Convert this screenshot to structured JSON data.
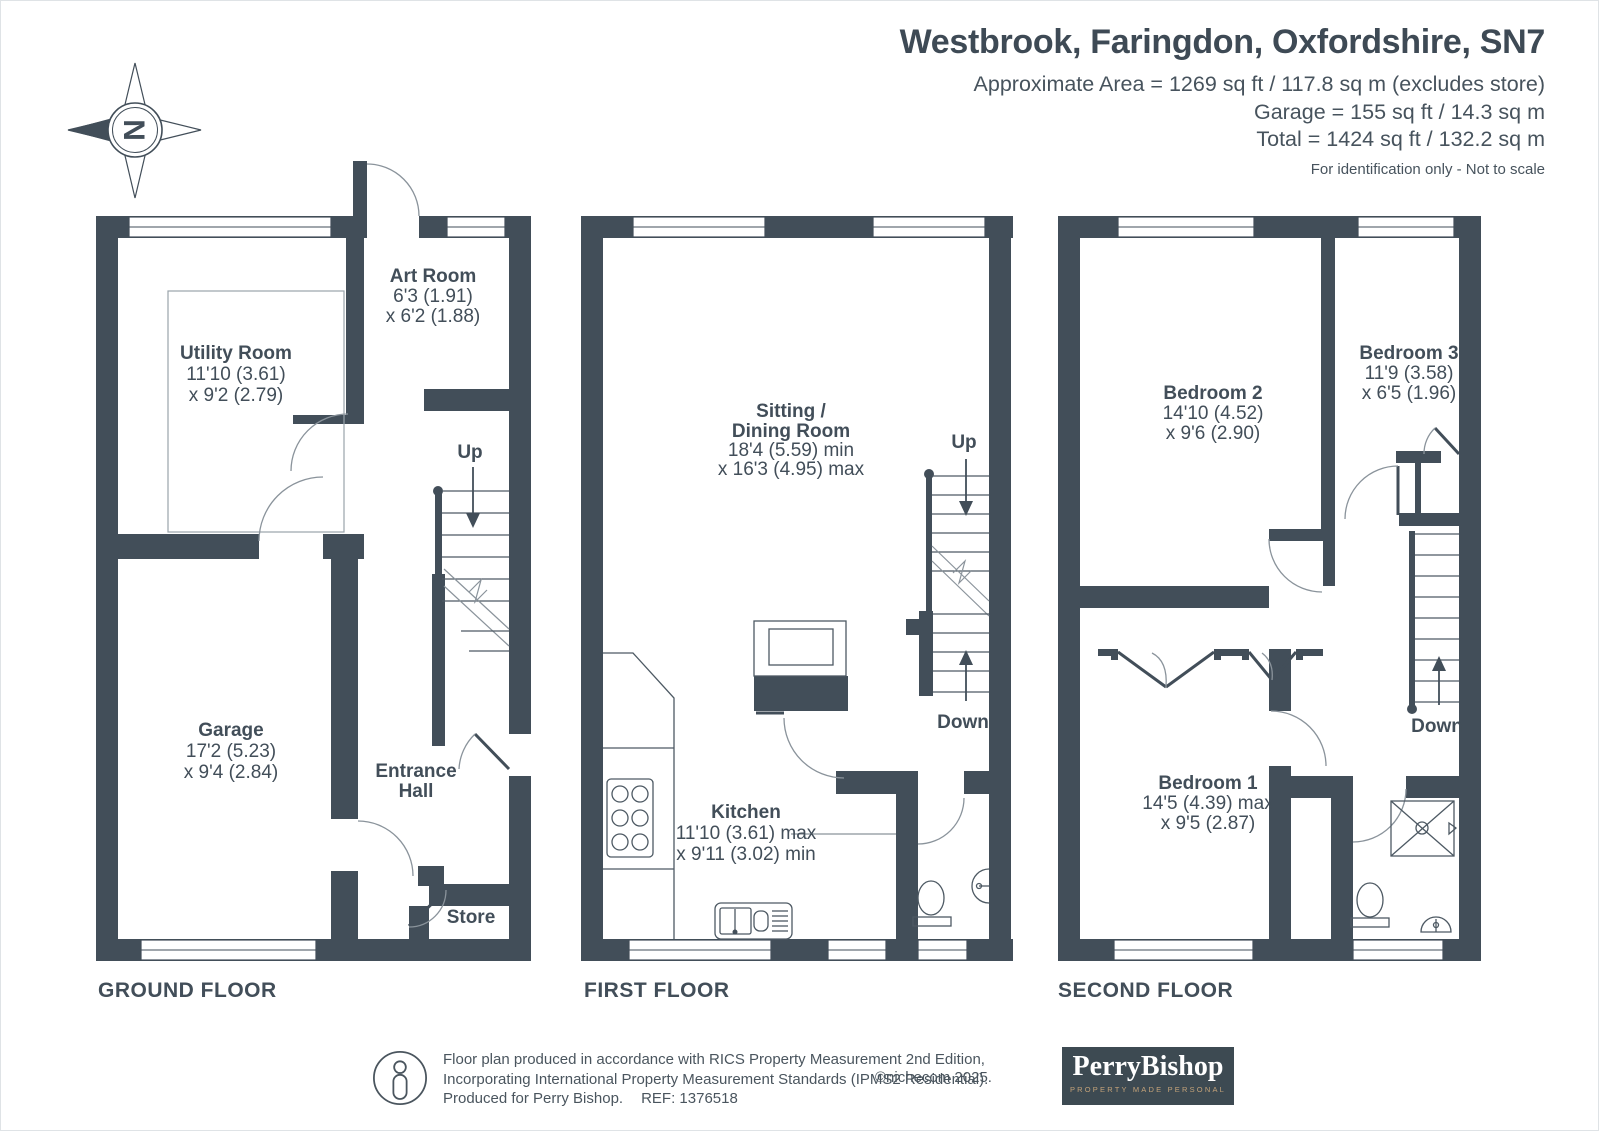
{
  "header": {
    "title": "Westbrook, Faringdon, Oxfordshire, SN7",
    "area_lines": [
      "Approximate Area = 1269 sq ft / 117.8 sq m (excludes store)",
      "Garage = 155 sq ft / 14.3 sq m",
      "Total = 1424 sq ft / 132.2 sq m"
    ],
    "disclaimer": "For identification only - Not to scale"
  },
  "compass": {
    "north_letter": "N"
  },
  "floors": {
    "ground": {
      "label": "GROUND FLOOR",
      "up_label": "Up",
      "rooms": {
        "utility": {
          "name": "Utility Room",
          "dim1": "11'10 (3.61)",
          "dim2": "x 9'2 (2.79)"
        },
        "art": {
          "name": "Art Room",
          "dim1": "6'3 (1.91)",
          "dim2": "x 6'2 (1.88)"
        },
        "garage": {
          "name": "Garage",
          "dim1": "17'2 (5.23)",
          "dim2": "x 9'4 (2.84)"
        },
        "entrance": {
          "name_line1": "Entrance",
          "name_line2": "Hall"
        },
        "store": {
          "name": "Store"
        }
      }
    },
    "first": {
      "label": "FIRST FLOOR",
      "up_label": "Up",
      "down_label": "Down",
      "rooms": {
        "sitting": {
          "name_line1": "Sitting /",
          "name_line2": "Dining Room",
          "dim1": "18'4 (5.59) min",
          "dim2": "x 16'3 (4.95) max"
        },
        "kitchen": {
          "name": "Kitchen",
          "dim1": "11'10 (3.61) max",
          "dim2": "x 9'11 (3.02) min"
        }
      }
    },
    "second": {
      "label": "SECOND FLOOR",
      "down_label": "Down",
      "rooms": {
        "bedroom2": {
          "name": "Bedroom 2",
          "dim1": "14'10 (4.52)",
          "dim2": "x 9'6 (2.90)"
        },
        "bedroom3": {
          "name": "Bedroom 3",
          "dim1": "11'9 (3.58)",
          "dim2": "x 6'5 (1.96)"
        },
        "bedroom1": {
          "name": "Bedroom 1",
          "dim1": "14'5 (4.39) max",
          "dim2": "x 9'5 (2.87)"
        }
      }
    }
  },
  "footer": {
    "line1": "Floor plan produced in accordance with RICS Property Measurement 2nd Edition,",
    "line2": "Incorporating International Property Measurement Standards (IPMS2 Residential).",
    "line3a": "Produced for Perry Bishop.",
    "line3b": "REF: 1376518",
    "copyright": "©nichecom 2025.",
    "logo": {
      "wordmark": "PerryBishop",
      "tagline": "PROPERTY MADE PERSONAL"
    }
  },
  "colors": {
    "wall": "#424E59",
    "logo_bg": "#3D4A52",
    "logo_tagline": "#C4A379"
  }
}
